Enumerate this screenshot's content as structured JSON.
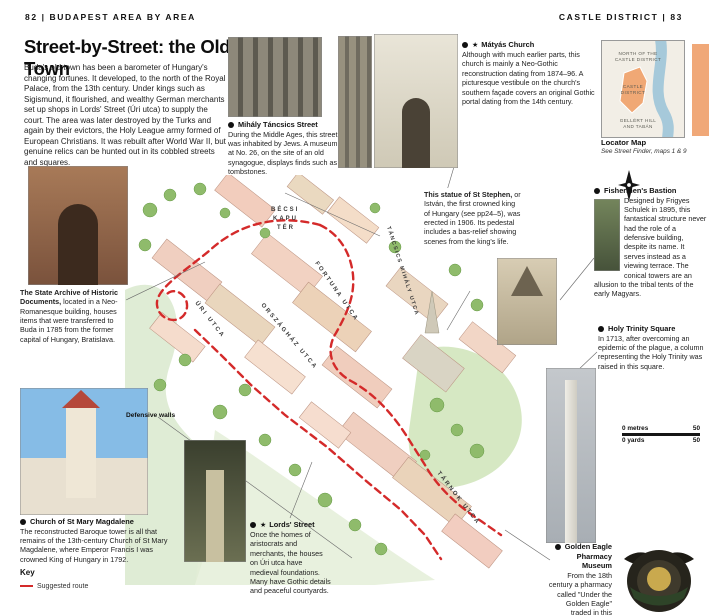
{
  "header": {
    "left": "82  |  BUDAPEST AREA BY AREA",
    "right": "CASTLE DISTRICT  |  83"
  },
  "intro": {
    "title": "Street-by-Street: the Old Town",
    "body": "Buda's old town has been a barometer of Hungary's changing fortunes. It developed, to the north of the Royal Palace, from the 13th century. Under kings such as Sigismund, it flourished, and wealthy German merchants set up shops in Lords' Street (Úri utca) to supply the court. The area was later destroyed by the Turks and again by their evictors, the Holy League army formed of European Christians. It was rebuilt after World War II, but genuine relics can be hunted out in its cobbled streets and squares."
  },
  "callouts": {
    "tancsics": {
      "title": "Mihály Táncsics Street",
      "body": "During the Middle Ages, this street was inhabited by Jews. A museum at No. 26, on the site of an old synagogue, displays finds such as tombstones."
    },
    "matyas": {
      "star": "★",
      "title": "Mátyás Church",
      "body": "Although with much earlier parts, this church is mainly a Neo-Gothic reconstruction dating from 1874–96. A picturesque vestibule on the church's southern façade covers an original Gothic portal dating from the 14th century."
    },
    "stephen": {
      "lead": "This statue of St Stephen,",
      "body": " or István, the first crowned king of Hungary (see pp24–5), was erected in 1906. Its pedestal includes a bas-relief showing scenes from the king's life."
    },
    "bastion": {
      "title": "Fishermen's Bastion",
      "body": "Designed by Frigyes Schulek in 1895, this fantastical structure never had the role of a defensive building, despite its name. It serves instead as a viewing terrace. The conical towers are an allusion to the tribal tents of the early Magyars."
    },
    "archive": {
      "lead": "The State Archive of Historic Documents,",
      "body": " located in a Neo-Romanesque building, houses items that were transferred to Buda in 1785 from the former capital of Hungary, Bratislava."
    },
    "trinity": {
      "title": "Holy Trinity Square",
      "body": "In 1713, after overcoming an epidemic of the plague, a column representing the Holy Trinity was raised in this square."
    },
    "magdalene": {
      "title": "Church of St Mary Magdalene",
      "body": "The reconstructed Baroque tower is all that remains of the 13th-century Church of St Mary Magdalene, where Emperor Francis I was crowned King of Hungary in 1792."
    },
    "lords": {
      "star": "★",
      "title": "Lords' Street",
      "body": "Once the homes of aristocrats and merchants, the houses on Úri utca have medieval foundations. Many have Gothic details and peaceful courtyards."
    },
    "eagle": {
      "title": "Golden Eagle Pharmacy Museum",
      "body": "From the 18th century a pharmacy called \"Under the Golden Eagle\" traded in this medieval house, now a museum."
    }
  },
  "map": {
    "labels": {
      "becsi_l1": "BÉCSI",
      "becsi_l2": "KAPU",
      "becsi_l3": "TÉR",
      "fortuna": "FORTUNA UTCA",
      "tancsics": "TÁNCSICS MIHÁLY UTCA",
      "orszaghaz": "ORSZÁGHÁZ UTCA",
      "uri": "ÚRI UTCA",
      "tarnok": "TÁRNOK UTCA",
      "defensive": "Defensive walls"
    },
    "route_color": "#d42a2a"
  },
  "locator": {
    "title": "Locator Map",
    "subtitle": "See Street Finder, maps 1 & 9",
    "l1": "NORTH OF THE",
    "l2": "CASTLE DISTRICT",
    "l3": "CASTLE",
    "l4": "DISTRICT",
    "l5": "GELLÉRT HILL",
    "l6": "AND TABÁN"
  },
  "key": {
    "title": "Key",
    "route": "Suggested route"
  },
  "scalebar": {
    "metres_label": "0 metres",
    "metres_value": "50",
    "yards_label": "0 yards",
    "yards_value": "50"
  },
  "colors": {
    "accent_red": "#d42a2a",
    "thumb_tab": "#f0a878",
    "district_highlight": "#f0a875"
  }
}
